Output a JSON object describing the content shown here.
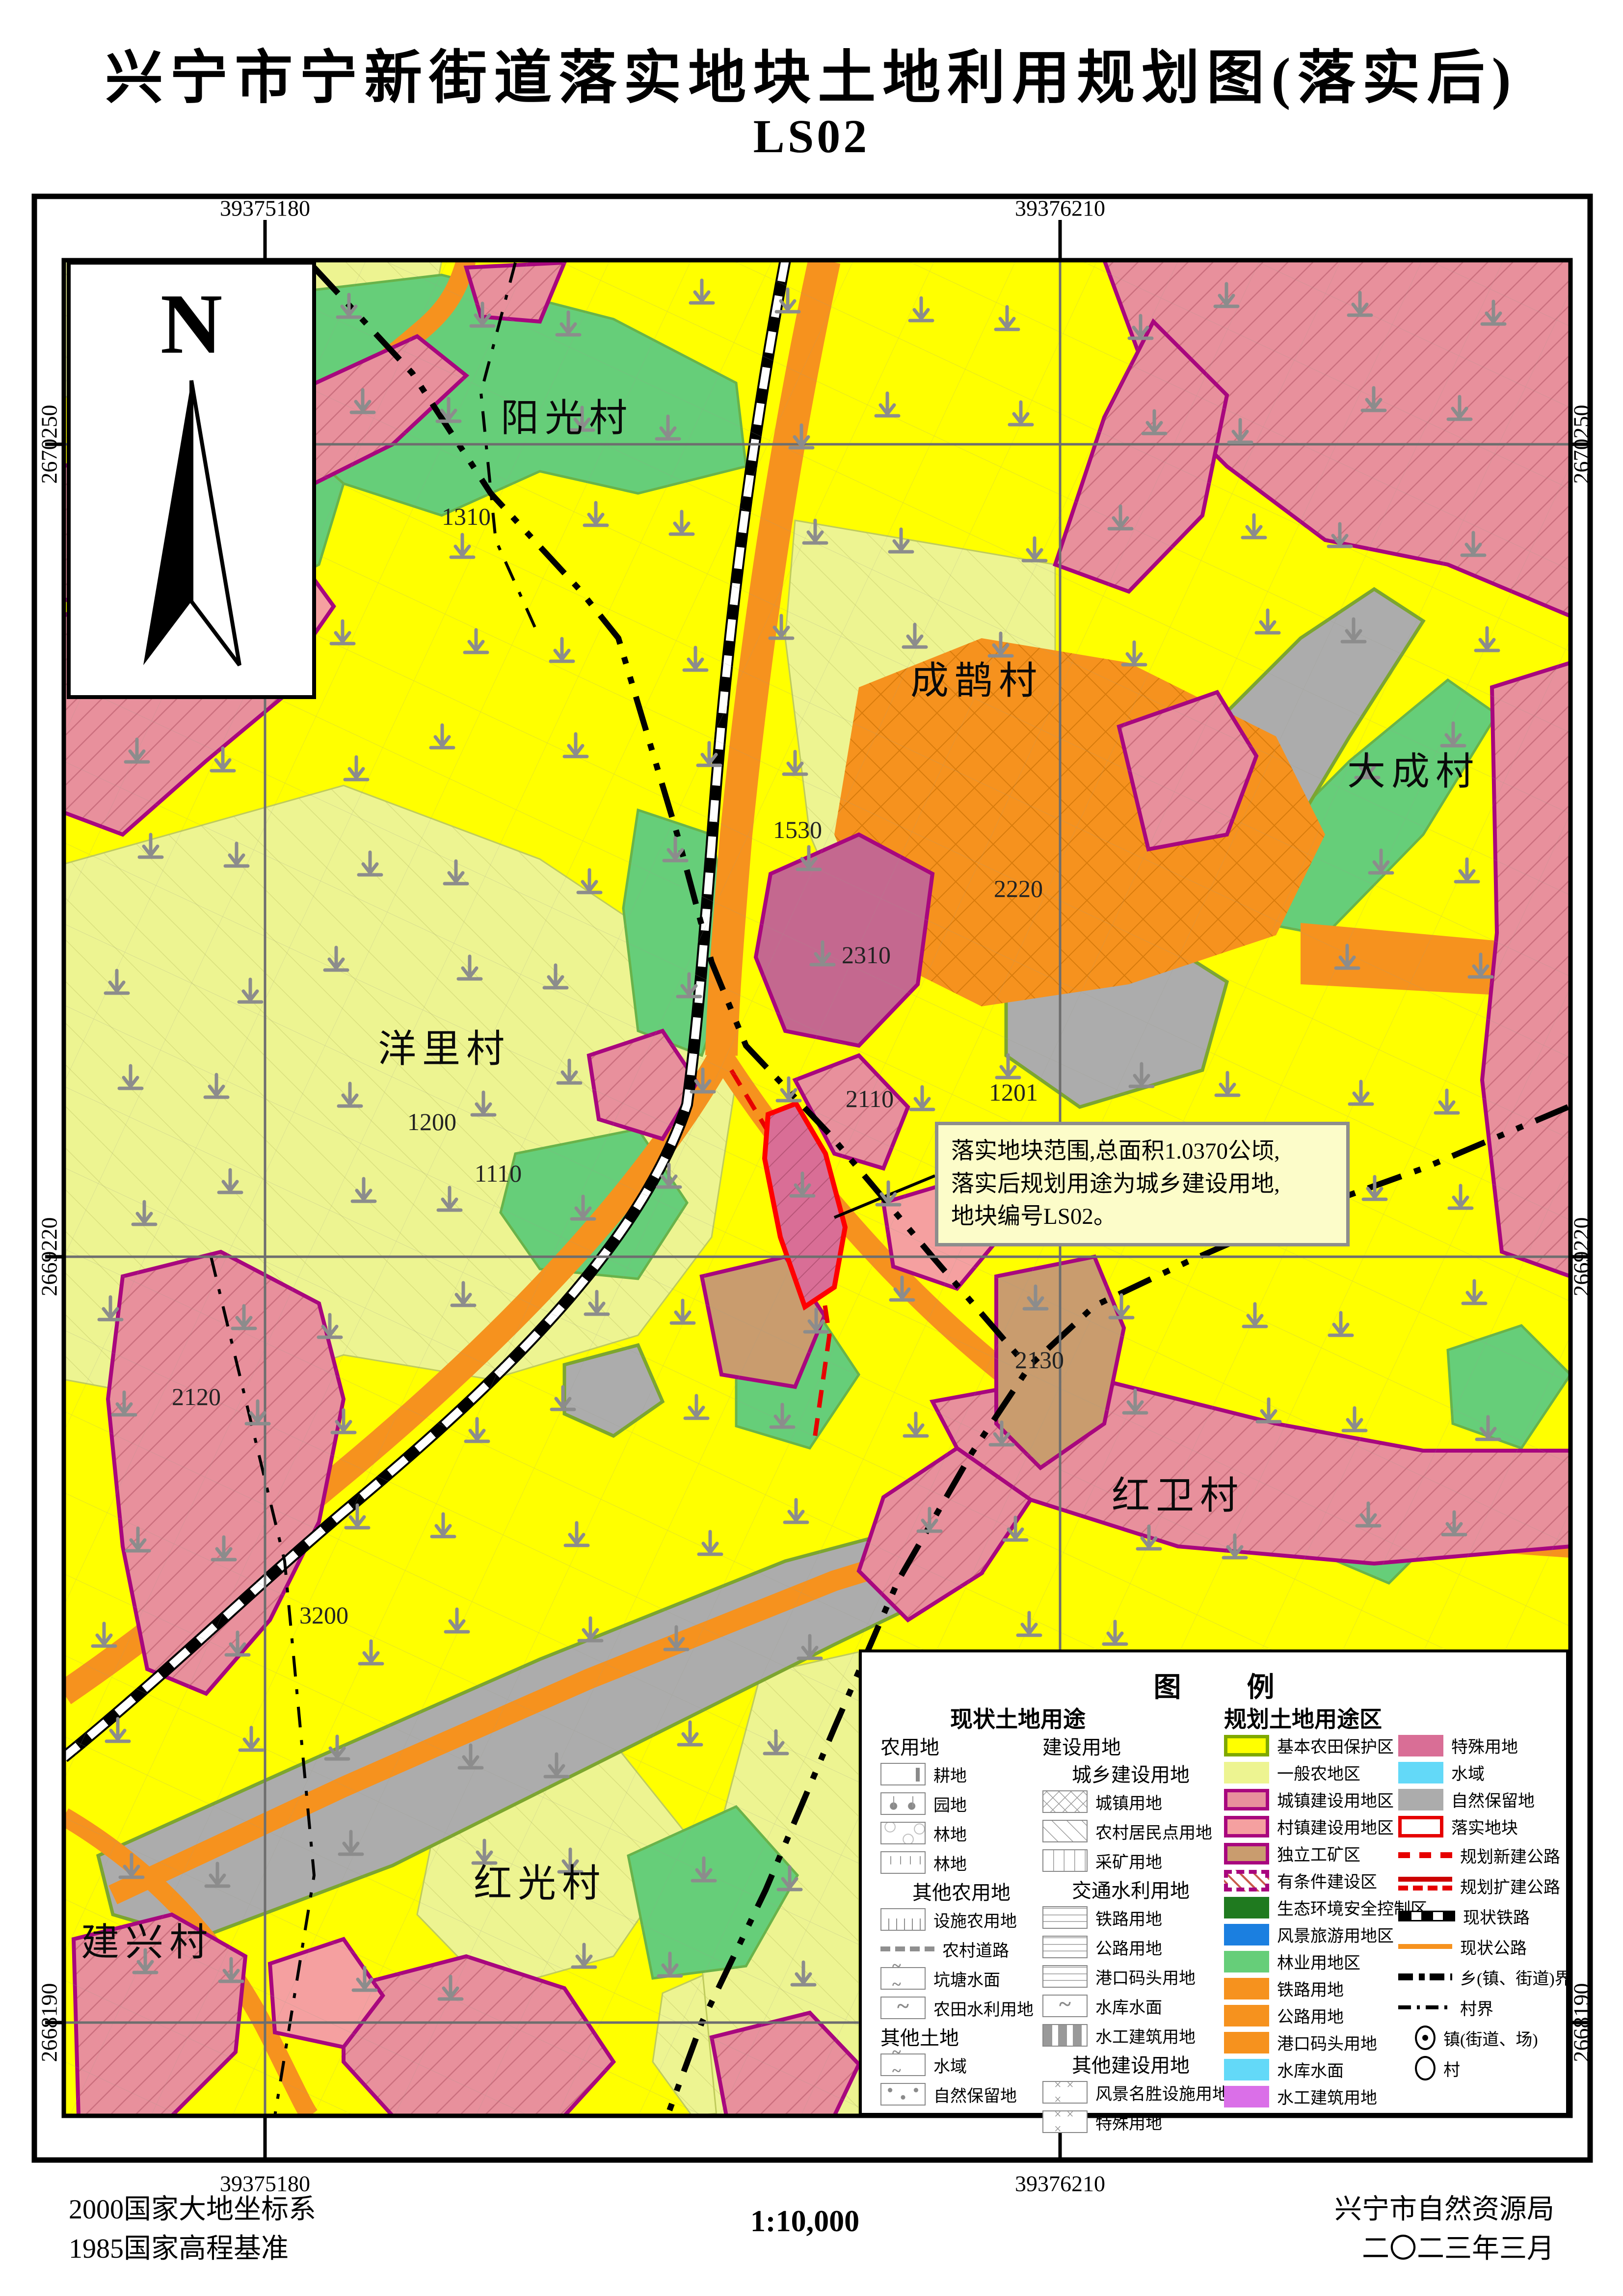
{
  "title": {
    "line1": "兴宁市宁新街道落实地块土地利用规划图(落实后)",
    "line2": "LS02"
  },
  "compass": {
    "n": "N"
  },
  "coords": {
    "top_left": "39375180",
    "top_right": "39376210",
    "bottom_left": "39375180",
    "bottom_right": "39376210",
    "left_top": "2670250",
    "left_mid": "2669220",
    "left_bottom": "2668190",
    "right_top": "2670250",
    "right_mid": "2669220",
    "right_bottom": "2668190"
  },
  "map": {
    "villages": [
      "阳光村",
      "成鹊村",
      "大成村",
      "洋里村",
      "红卫村",
      "红光村",
      "建兴村"
    ],
    "codes": [
      "1310",
      "1530",
      "2220",
      "2310",
      "2110",
      "1201",
      "1200",
      "1110",
      "2120",
      "3200",
      "2130"
    ],
    "annotation": [
      "落实地块范围,总面积1.0370公顷,",
      "落实后规划用途为城乡建设用地,",
      "地块编号LS02。"
    ]
  },
  "legend": {
    "title": "图  例",
    "current": {
      "header": "现状土地用途",
      "colA": {
        "g1": "农用地",
        "items1": [
          "耕地",
          "园地",
          "林地",
          "林地"
        ],
        "g2": "其他农用地",
        "items2": [
          "设施农用地",
          "农村道路",
          "坑塘水面",
          "农田水利用地"
        ],
        "g3": "其他土地",
        "items3": [
          "水域",
          "自然保留地"
        ]
      },
      "colB": {
        "g1": "建设用地",
        "s1": "城乡建设用地",
        "items1": [
          "城镇用地",
          "农村居民点用地",
          "采矿用地"
        ],
        "s2": "交通水利用地",
        "items2": [
          "铁路用地",
          "公路用地",
          "港口码头用地",
          "水库水面",
          "水工建筑用地"
        ],
        "s3": "其他建设用地",
        "items3": [
          "风景名胜设施用地",
          "特殊用地"
        ]
      }
    },
    "planned": {
      "header": "规划土地用途区",
      "colC": [
        "基本农田保护区",
        "一般农地区",
        "城镇建设用地区",
        "村镇建设用地区",
        "独立工矿区",
        "有条件建设区",
        "生态环境安全控制区",
        "风景旅游用地区",
        "林业用地区",
        "铁路用地",
        "公路用地",
        "港口码头用地",
        "水库水面",
        "水工建筑用地"
      ],
      "colD": [
        "特殊用地",
        "水域",
        "自然保留地",
        "落实地块",
        "规划新建公路",
        "规划扩建公路",
        "现状铁路",
        "现状公路",
        "乡(镇、街道)界",
        "村界",
        "镇(街道、场)",
        "村"
      ]
    },
    "colors": {
      "basic_farmland": "#FFFF00",
      "general_agri": "#EDF491",
      "town_constr": "#E8909C",
      "village_constr": "#F5A0A0",
      "mining_zone": "#C99C6E",
      "zone_border": "#A8077E",
      "eco_control": "#1F7A1F",
      "scenic": "#1B7FE0",
      "forestry": "#66CE79",
      "transport_orange": "#F6921E",
      "special": "#D96E96",
      "water": "#63D9F8",
      "nature_reserve": "#ACACAC",
      "hydro": "#DA6FE8",
      "plot_red": "#E60000"
    }
  },
  "footer": {
    "datum1": "2000国家大地坐标系",
    "datum2": "1985国家高程基准",
    "scale": "1:10,000",
    "agency": "兴宁市自然资源局",
    "date": "二〇二三年三月"
  }
}
